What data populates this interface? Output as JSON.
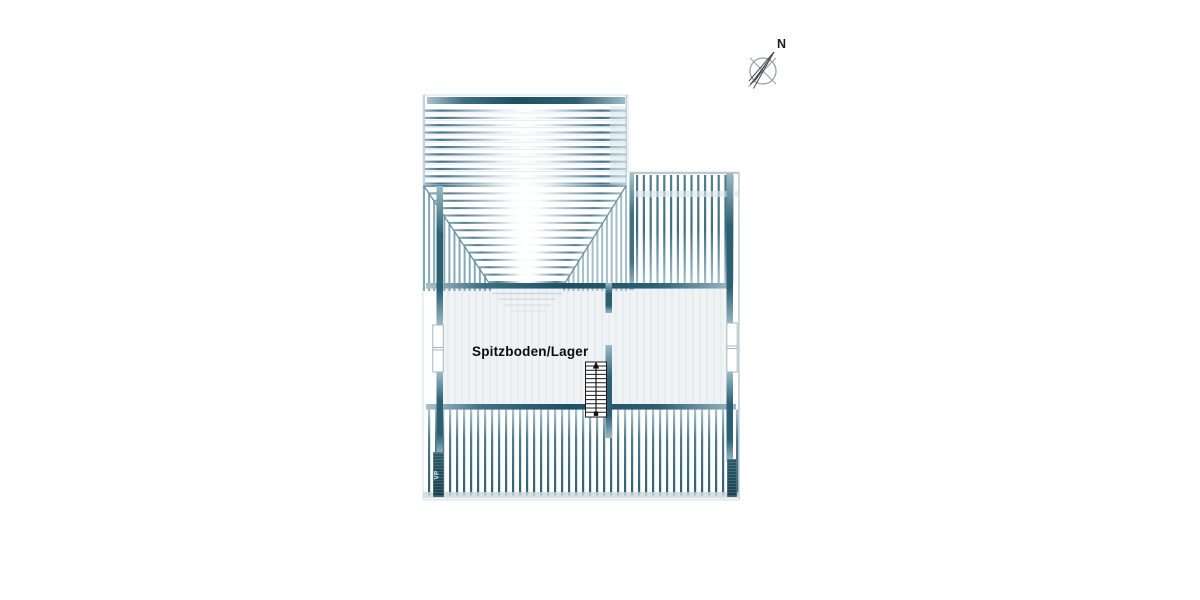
{
  "compass": {
    "north_label": "N"
  },
  "plan": {
    "room_label": "Spitzboden/Lager",
    "watermark_left": "VP",
    "watermark_right": ""
  },
  "colors": {
    "beam_dark": "#1e4f64",
    "beam_mid": "#2d5f73",
    "rafter": "#44708a",
    "rafter_light": "#9bb9c6",
    "rafter_pale": "#cfdce1",
    "outline_light": "#d9e1e5",
    "band_light": "#d8e5ea",
    "edge_light": "#c3d3da",
    "room_fill": "#f0f3f5",
    "room_stripe": "#e2e8ec",
    "frame_shadow": "#c2cfd6",
    "window_frame": "#a9b6bc",
    "stair_line": "#1a1a1a",
    "compass_gray": "#9aa1a6",
    "needle_dark": "#42474b",
    "bottom_band": "#ccd6db",
    "label_color": "#0c0c0c"
  }
}
